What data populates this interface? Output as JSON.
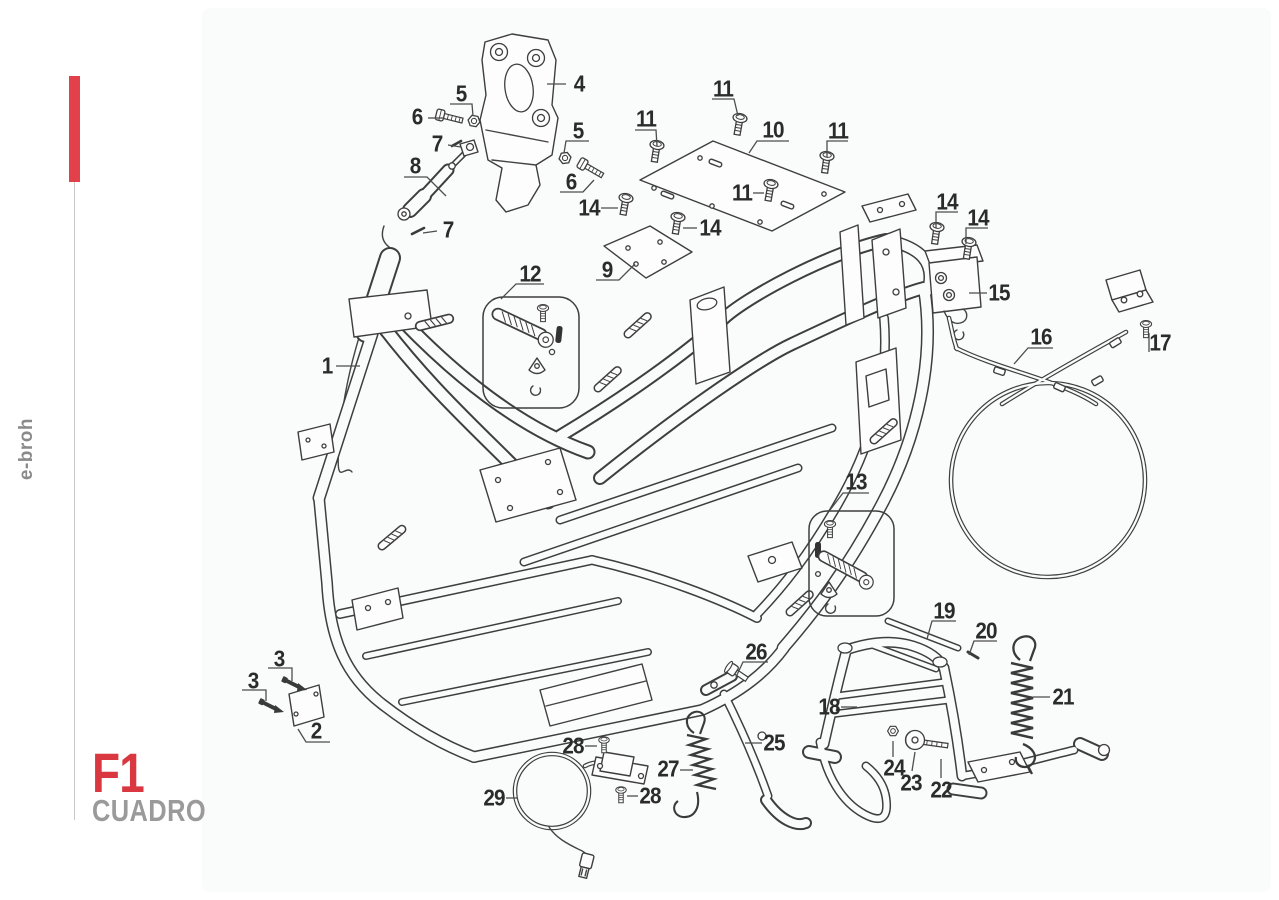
{
  "sidebar": {
    "brand": "e-broh",
    "figure_code": "F1",
    "figure_title": "CUADRO"
  },
  "colors": {
    "accent_red": "#E2414B",
    "title_red": "#D93840",
    "muted_gray": "#9A9A9A",
    "line_dark": "#3E3E3E",
    "panel_bg": "#FAFBFB"
  },
  "callouts": [
    {
      "label": "1"
    },
    {
      "label": "2"
    },
    {
      "label": "3"
    },
    {
      "label": "3"
    },
    {
      "label": "4"
    },
    {
      "label": "5"
    },
    {
      "label": "5"
    },
    {
      "label": "6"
    },
    {
      "label": "6"
    },
    {
      "label": "7"
    },
    {
      "label": "7"
    },
    {
      "label": "8"
    },
    {
      "label": "9"
    },
    {
      "label": "10"
    },
    {
      "label": "11"
    },
    {
      "label": "11"
    },
    {
      "label": "11"
    },
    {
      "label": "11"
    },
    {
      "label": "12"
    },
    {
      "label": "13"
    },
    {
      "label": "14"
    },
    {
      "label": "14"
    },
    {
      "label": "14"
    },
    {
      "label": "14"
    },
    {
      "label": "15"
    },
    {
      "label": "16"
    },
    {
      "label": "17"
    },
    {
      "label": "18"
    },
    {
      "label": "19"
    },
    {
      "label": "20"
    },
    {
      "label": "21"
    },
    {
      "label": "22"
    },
    {
      "label": "23"
    },
    {
      "label": "24"
    },
    {
      "label": "25"
    },
    {
      "label": "26"
    },
    {
      "label": "27"
    },
    {
      "label": "28"
    },
    {
      "label": "28"
    },
    {
      "label": "29"
    }
  ]
}
